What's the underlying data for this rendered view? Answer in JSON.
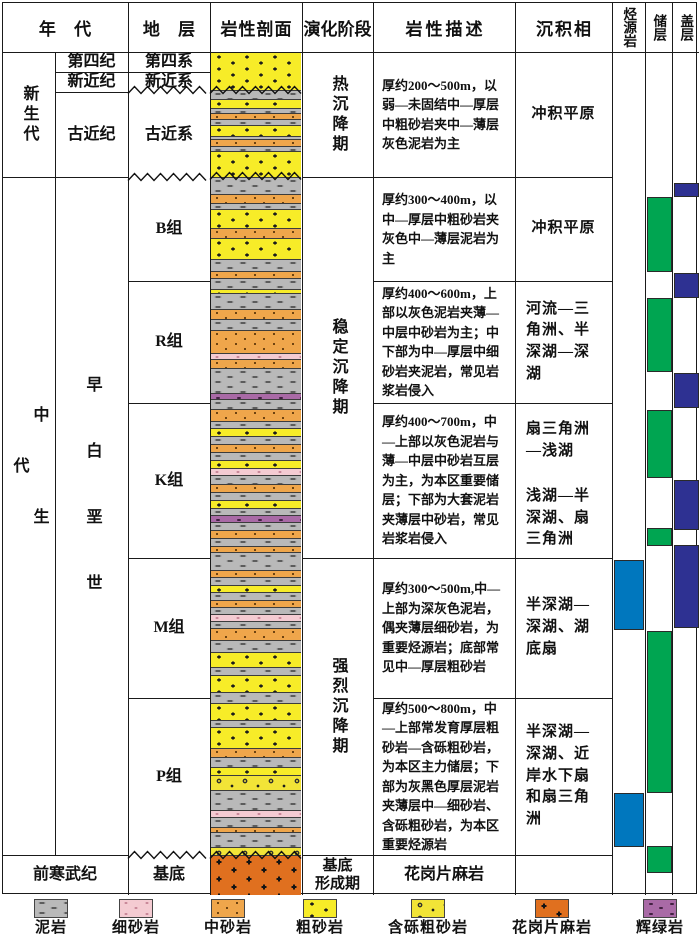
{
  "title": "stratigraphic-evolution-column",
  "colors": {
    "line": "#1a1a1a",
    "source_rock_blue": "#0077be",
    "reservoir_green": "#00a551",
    "seal_navy": "#2e3192",
    "mudstone_gray": "#b9b9b9",
    "fine_sand_pink": "#f4cbd2",
    "medium_sand_orange": "#efa64b",
    "coarse_sand_yellow": "#f7ec28",
    "pebbly_sand_yellow": "#f2e437",
    "gneiss_orange": "#e0701f",
    "diabase_purple": "#a96aa6"
  },
  "header": {
    "era": "年 代",
    "strata": "地 层",
    "litho": "岩性剖面",
    "evolution": "演化阶段",
    "description": "岩性描述",
    "facies": "沉积相",
    "source_rock": "烃源岩",
    "reservoir": "储层",
    "seal": "盖层"
  },
  "cells": [
    {
      "name": "era-cenozoic",
      "label": "新生代",
      "x": 2,
      "y": 52,
      "w": 53,
      "h": 125,
      "cls": "v"
    },
    {
      "name": "era-mesozoic",
      "label": "中生代",
      "x": 2,
      "y": 382,
      "w": 53,
      "h": 252,
      "cls": "v sp2"
    },
    {
      "name": "period-quaternary",
      "label": "第四纪",
      "x": 55,
      "y": 52,
      "w": 73,
      "h": 20
    },
    {
      "name": "period-neogene",
      "label": "新近纪",
      "x": 55,
      "y": 72,
      "w": 73,
      "h": 20
    },
    {
      "name": "period-paleogene",
      "label": "古近纪",
      "x": 55,
      "y": 92,
      "w": 73,
      "h": 85
    },
    {
      "name": "period-early-cretaceous",
      "label": "早白垩世",
      "x": 55,
      "y": 368,
      "w": 73,
      "h": 280,
      "cls": "v sp1"
    },
    {
      "name": "era-precambrian",
      "label": "前寒武纪",
      "x": 2,
      "y": 855,
      "w": 126,
      "h": 40
    },
    {
      "name": "stratum-quaternary",
      "label": "第四系",
      "x": 128,
      "y": 52,
      "w": 82,
      "h": 20
    },
    {
      "name": "stratum-neogene",
      "label": "新近系",
      "x": 128,
      "y": 72,
      "w": 82,
      "h": 20
    },
    {
      "name": "stratum-paleogene",
      "label": "古近系",
      "x": 128,
      "y": 92,
      "w": 82,
      "h": 85
    },
    {
      "name": "stratum-b",
      "label": "B组",
      "x": 128,
      "y": 177,
      "w": 82,
      "h": 104
    },
    {
      "name": "stratum-r",
      "label": "R组",
      "x": 128,
      "y": 281,
      "w": 82,
      "h": 122
    },
    {
      "name": "stratum-k",
      "label": "K组",
      "x": 128,
      "y": 403,
      "w": 82,
      "h": 155
    },
    {
      "name": "stratum-m",
      "label": "M组",
      "x": 128,
      "y": 558,
      "w": 82,
      "h": 140
    },
    {
      "name": "stratum-p",
      "label": "P组",
      "x": 128,
      "y": 698,
      "w": 82,
      "h": 157
    },
    {
      "name": "stratum-basement",
      "label": "基底",
      "x": 128,
      "y": 855,
      "w": 82,
      "h": 40
    },
    {
      "name": "stage-thermal-subsidence",
      "label": "热沉降期",
      "x": 302,
      "y": 52,
      "w": 71,
      "h": 125,
      "cls": "v"
    },
    {
      "name": "stage-stable-subsidence",
      "label": "稳定沉降期",
      "x": 302,
      "y": 177,
      "w": 71,
      "h": 381,
      "cls": "v"
    },
    {
      "name": "stage-intense-subsidence",
      "label": "强烈沉降期",
      "x": 302,
      "y": 558,
      "w": 71,
      "h": 297,
      "cls": "v"
    },
    {
      "name": "stage-basement-formation",
      "label": "基底\n形成期",
      "x": 302,
      "y": 855,
      "w": 71,
      "h": 40,
      "cls": "two"
    },
    {
      "name": "desc-cenozoic",
      "label": "厚约200～500m，以弱—未固结中—厚层中粗砂岩夹中—薄层灰色泥岩为主",
      "x": 373,
      "y": 52,
      "w": 142,
      "h": 125,
      "cls": "desc"
    },
    {
      "name": "desc-b",
      "label": "厚约300～400m，以中—厚层中粗砂岩夹灰色中—薄层泥岩为主",
      "x": 373,
      "y": 177,
      "w": 142,
      "h": 104,
      "cls": "desc"
    },
    {
      "name": "desc-r",
      "label": "厚约400～600m，上部以灰色泥岩夹薄—中层中砂岩为主；中下部为中—厚层中细砂岩夹泥岩，常见岩浆岩侵入",
      "x": 373,
      "y": 281,
      "w": 142,
      "h": 122,
      "cls": "desc"
    },
    {
      "name": "desc-k",
      "label": "厚约400～700m，中—上部以灰色泥岩与薄—中层中砂岩互层为主，为本区重要储层；下部为大套泥岩夹薄层中砂岩，常见岩浆岩侵入",
      "x": 373,
      "y": 403,
      "w": 142,
      "h": 155,
      "cls": "desc"
    },
    {
      "name": "desc-m",
      "label": "厚约300～500m,中—上部为深灰色泥岩，偶夹薄层细砂岩，为重要烃源岩；底部常见中—厚层粗砂岩",
      "x": 373,
      "y": 558,
      "w": 142,
      "h": 140,
      "cls": "desc"
    },
    {
      "name": "desc-p",
      "label": "厚约500～800m，中—上部常发育厚层粗砂岩—含砾粗砂岩，为本区主力储层；下部为灰黑色厚层泥岩夹薄层中—细砂岩、含砾粗砂岩，为本区重要烃源岩",
      "x": 373,
      "y": 698,
      "w": 142,
      "h": 157,
      "cls": "desc"
    },
    {
      "name": "desc-basement",
      "label": "花岗片麻岩",
      "x": 373,
      "y": 855,
      "w": 142,
      "h": 40,
      "cls": "ctr"
    },
    {
      "name": "facies-cenozoic",
      "label": "冲积平原",
      "x": 515,
      "y": 52,
      "w": 97,
      "h": 125,
      "cls": "fac"
    },
    {
      "name": "facies-b",
      "label": "冲积平原",
      "x": 515,
      "y": 177,
      "w": 97,
      "h": 104,
      "cls": "fac"
    },
    {
      "name": "facies-r",
      "label": "河流—三角洲、半深湖—深湖",
      "x": 515,
      "y": 281,
      "w": 97,
      "h": 122,
      "cls": "fac"
    },
    {
      "name": "facies-k-upper",
      "label": "扇三角洲—浅湖",
      "x": 515,
      "y": 403,
      "w": 97,
      "h": 76,
      "cls": "fac"
    },
    {
      "name": "facies-k-lower",
      "label": "浅湖—半深湖、扇三角洲",
      "x": 515,
      "y": 479,
      "w": 97,
      "h": 79,
      "cls": "fac"
    },
    {
      "name": "facies-m",
      "label": "半深湖—深湖、湖底扇",
      "x": 515,
      "y": 558,
      "w": 97,
      "h": 140,
      "cls": "fac"
    },
    {
      "name": "facies-p",
      "label": "半深湖—深湖、近岸水下扇和扇三角洲",
      "x": 515,
      "y": 698,
      "w": 97,
      "h": 157,
      "cls": "fac"
    }
  ],
  "grid": {
    "vlines": [
      {
        "x": 55,
        "y1": 52,
        "y2": 855
      },
      {
        "x": 128,
        "y1": 2,
        "y2": 895
      },
      {
        "x": 210,
        "y1": 2,
        "y2": 895
      },
      {
        "x": 302,
        "y1": 2,
        "y2": 895
      },
      {
        "x": 373,
        "y1": 2,
        "y2": 895
      },
      {
        "x": 515,
        "y1": 2,
        "y2": 895
      },
      {
        "x": 612,
        "y1": 2,
        "y2": 895
      },
      {
        "x": 645,
        "y1": 2,
        "y2": 895
      },
      {
        "x": 672,
        "y1": 2,
        "y2": 895
      }
    ],
    "hlines": [
      {
        "y": 52,
        "x1": 2,
        "x2": 699
      },
      {
        "y": 72,
        "x1": 55,
        "x2": 210
      },
      {
        "y": 92,
        "x1": 55,
        "x2": 128
      },
      {
        "y": 177,
        "x1": 2,
        "x2": 128
      },
      {
        "y": 177,
        "x1": 302,
        "x2": 612
      },
      {
        "y": 281,
        "x1": 128,
        "x2": 210
      },
      {
        "y": 281,
        "x1": 373,
        "x2": 612
      },
      {
        "y": 403,
        "x1": 128,
        "x2": 210
      },
      {
        "y": 403,
        "x1": 373,
        "x2": 612
      },
      {
        "y": 558,
        "x1": 128,
        "x2": 210
      },
      {
        "y": 558,
        "x1": 302,
        "x2": 612
      },
      {
        "y": 698,
        "x1": 128,
        "x2": 210
      },
      {
        "y": 698,
        "x1": 373,
        "x2": 612
      },
      {
        "y": 855,
        "x1": 2,
        "x2": 128
      },
      {
        "y": 855,
        "x1": 302,
        "x2": 612
      }
    ],
    "wavy": [
      {
        "x": 128,
        "y": 90,
        "w": 82
      },
      {
        "x": 210,
        "y": 90,
        "w": 92
      },
      {
        "x": 128,
        "y": 177,
        "w": 82
      },
      {
        "x": 210,
        "y": 176,
        "w": 92
      },
      {
        "x": 128,
        "y": 855,
        "w": 82
      },
      {
        "x": 210,
        "y": 855,
        "w": 92
      }
    ]
  },
  "lithology_column": {
    "x": 211,
    "w": 90,
    "top": 52,
    "bottom": 895,
    "layers": [
      {
        "t": 52,
        "b": 90,
        "k": "coarse"
      },
      {
        "t": 90,
        "b": 99,
        "k": "mud"
      },
      {
        "t": 99,
        "b": 108,
        "k": "coarse"
      },
      {
        "t": 108,
        "b": 113,
        "k": "mud"
      },
      {
        "t": 113,
        "b": 119,
        "k": "med"
      },
      {
        "t": 119,
        "b": 125,
        "k": "mud"
      },
      {
        "t": 125,
        "b": 136,
        "k": "coarse"
      },
      {
        "t": 136,
        "b": 139,
        "k": "mud"
      },
      {
        "t": 139,
        "b": 146,
        "k": "med"
      },
      {
        "t": 146,
        "b": 151,
        "k": "mud"
      },
      {
        "t": 151,
        "b": 177,
        "k": "coarse"
      },
      {
        "t": 177,
        "b": 194,
        "k": "mud"
      },
      {
        "t": 194,
        "b": 203,
        "k": "med"
      },
      {
        "t": 203,
        "b": 209,
        "k": "mud"
      },
      {
        "t": 209,
        "b": 228,
        "k": "coarse"
      },
      {
        "t": 228,
        "b": 238,
        "k": "med"
      },
      {
        "t": 238,
        "b": 259,
        "k": "coarse"
      },
      {
        "t": 259,
        "b": 271,
        "k": "mud"
      },
      {
        "t": 271,
        "b": 278,
        "k": "med"
      },
      {
        "t": 278,
        "b": 289,
        "k": "mud"
      },
      {
        "t": 289,
        "b": 293,
        "k": "coarse"
      },
      {
        "t": 293,
        "b": 309,
        "k": "mud"
      },
      {
        "t": 309,
        "b": 319,
        "k": "med"
      },
      {
        "t": 319,
        "b": 330,
        "k": "mud"
      },
      {
        "t": 330,
        "b": 353,
        "k": "med"
      },
      {
        "t": 353,
        "b": 359,
        "k": "fine"
      },
      {
        "t": 359,
        "b": 368,
        "k": "med"
      },
      {
        "t": 368,
        "b": 393,
        "k": "mud"
      },
      {
        "t": 393,
        "b": 399,
        "k": "diabase"
      },
      {
        "t": 399,
        "b": 409,
        "k": "mud"
      },
      {
        "t": 409,
        "b": 421,
        "k": "med"
      },
      {
        "t": 421,
        "b": 428,
        "k": "mud"
      },
      {
        "t": 428,
        "b": 436,
        "k": "coarse"
      },
      {
        "t": 436,
        "b": 444,
        "k": "mud"
      },
      {
        "t": 444,
        "b": 452,
        "k": "med"
      },
      {
        "t": 452,
        "b": 460,
        "k": "mud"
      },
      {
        "t": 460,
        "b": 468,
        "k": "coarse"
      },
      {
        "t": 468,
        "b": 475,
        "k": "fine"
      },
      {
        "t": 475,
        "b": 484,
        "k": "mud"
      },
      {
        "t": 484,
        "b": 492,
        "k": "med"
      },
      {
        "t": 492,
        "b": 500,
        "k": "mud"
      },
      {
        "t": 500,
        "b": 508,
        "k": "coarse"
      },
      {
        "t": 508,
        "b": 515,
        "k": "mud"
      },
      {
        "t": 515,
        "b": 522,
        "k": "diabase"
      },
      {
        "t": 522,
        "b": 530,
        "k": "mud"
      },
      {
        "t": 530,
        "b": 538,
        "k": "med"
      },
      {
        "t": 538,
        "b": 546,
        "k": "mud"
      },
      {
        "t": 546,
        "b": 552,
        "k": "med"
      },
      {
        "t": 552,
        "b": 570,
        "k": "mud"
      },
      {
        "t": 570,
        "b": 577,
        "k": "med"
      },
      {
        "t": 577,
        "b": 585,
        "k": "mud"
      },
      {
        "t": 585,
        "b": 592,
        "k": "coarse"
      },
      {
        "t": 592,
        "b": 600,
        "k": "mud"
      },
      {
        "t": 600,
        "b": 607,
        "k": "med"
      },
      {
        "t": 607,
        "b": 614,
        "k": "mud"
      },
      {
        "t": 614,
        "b": 621,
        "k": "fine"
      },
      {
        "t": 621,
        "b": 628,
        "k": "mud"
      },
      {
        "t": 628,
        "b": 640,
        "k": "med"
      },
      {
        "t": 640,
        "b": 652,
        "k": "mud"
      },
      {
        "t": 652,
        "b": 667,
        "k": "coarse"
      },
      {
        "t": 667,
        "b": 675,
        "k": "mud"
      },
      {
        "t": 675,
        "b": 692,
        "k": "coarse"
      },
      {
        "t": 692,
        "b": 703,
        "k": "mud"
      },
      {
        "t": 703,
        "b": 720,
        "k": "coarse"
      },
      {
        "t": 720,
        "b": 727,
        "k": "mud"
      },
      {
        "t": 727,
        "b": 748,
        "k": "coarse"
      },
      {
        "t": 748,
        "b": 757,
        "k": "med"
      },
      {
        "t": 757,
        "b": 767,
        "k": "mud"
      },
      {
        "t": 767,
        "b": 775,
        "k": "coarse"
      },
      {
        "t": 775,
        "b": 790,
        "k": "pebbly"
      },
      {
        "t": 790,
        "b": 810,
        "k": "mud"
      },
      {
        "t": 810,
        "b": 817,
        "k": "fine"
      },
      {
        "t": 817,
        "b": 827,
        "k": "mud"
      },
      {
        "t": 827,
        "b": 832,
        "k": "med"
      },
      {
        "t": 832,
        "b": 847,
        "k": "mud"
      },
      {
        "t": 847,
        "b": 855,
        "k": "pebbly"
      },
      {
        "t": 855,
        "b": 895,
        "k": "gneiss"
      }
    ]
  },
  "indicators": {
    "columns": [
      {
        "name": "source-rock-column",
        "x": 613.5,
        "w": 30.5,
        "color": "#0077be",
        "blocks": [
          {
            "t": 560,
            "b": 630
          },
          {
            "t": 793,
            "b": 847
          }
        ]
      },
      {
        "name": "reservoir-column",
        "x": 646.5,
        "w": 25,
        "color": "#00a551",
        "blocks": [
          {
            "t": 197,
            "b": 272
          },
          {
            "t": 298,
            "b": 372
          },
          {
            "t": 410,
            "b": 478
          },
          {
            "t": 528,
            "b": 546
          },
          {
            "t": 631,
            "b": 793
          },
          {
            "t": 846,
            "b": 873
          }
        ]
      },
      {
        "name": "seal-column",
        "x": 673.5,
        "w": 25,
        "color": "#2e3192",
        "blocks": [
          {
            "t": 183,
            "b": 197
          },
          {
            "t": 273,
            "b": 298
          },
          {
            "t": 373,
            "b": 408
          },
          {
            "t": 480,
            "b": 530
          },
          {
            "t": 545,
            "b": 628
          }
        ]
      }
    ]
  },
  "legend": {
    "items": [
      {
        "label": "泥岩",
        "type": "mud"
      },
      {
        "label": "细砂岩",
        "type": "fine"
      },
      {
        "label": "中砂岩",
        "type": "med"
      },
      {
        "label": "粗砂岩",
        "type": "coarse"
      },
      {
        "label": "含砾粗砂岩",
        "type": "pebbly"
      },
      {
        "label": "花岗片麻岩",
        "type": "gneiss"
      },
      {
        "label": "辉绿岩",
        "type": "diabase"
      }
    ]
  }
}
